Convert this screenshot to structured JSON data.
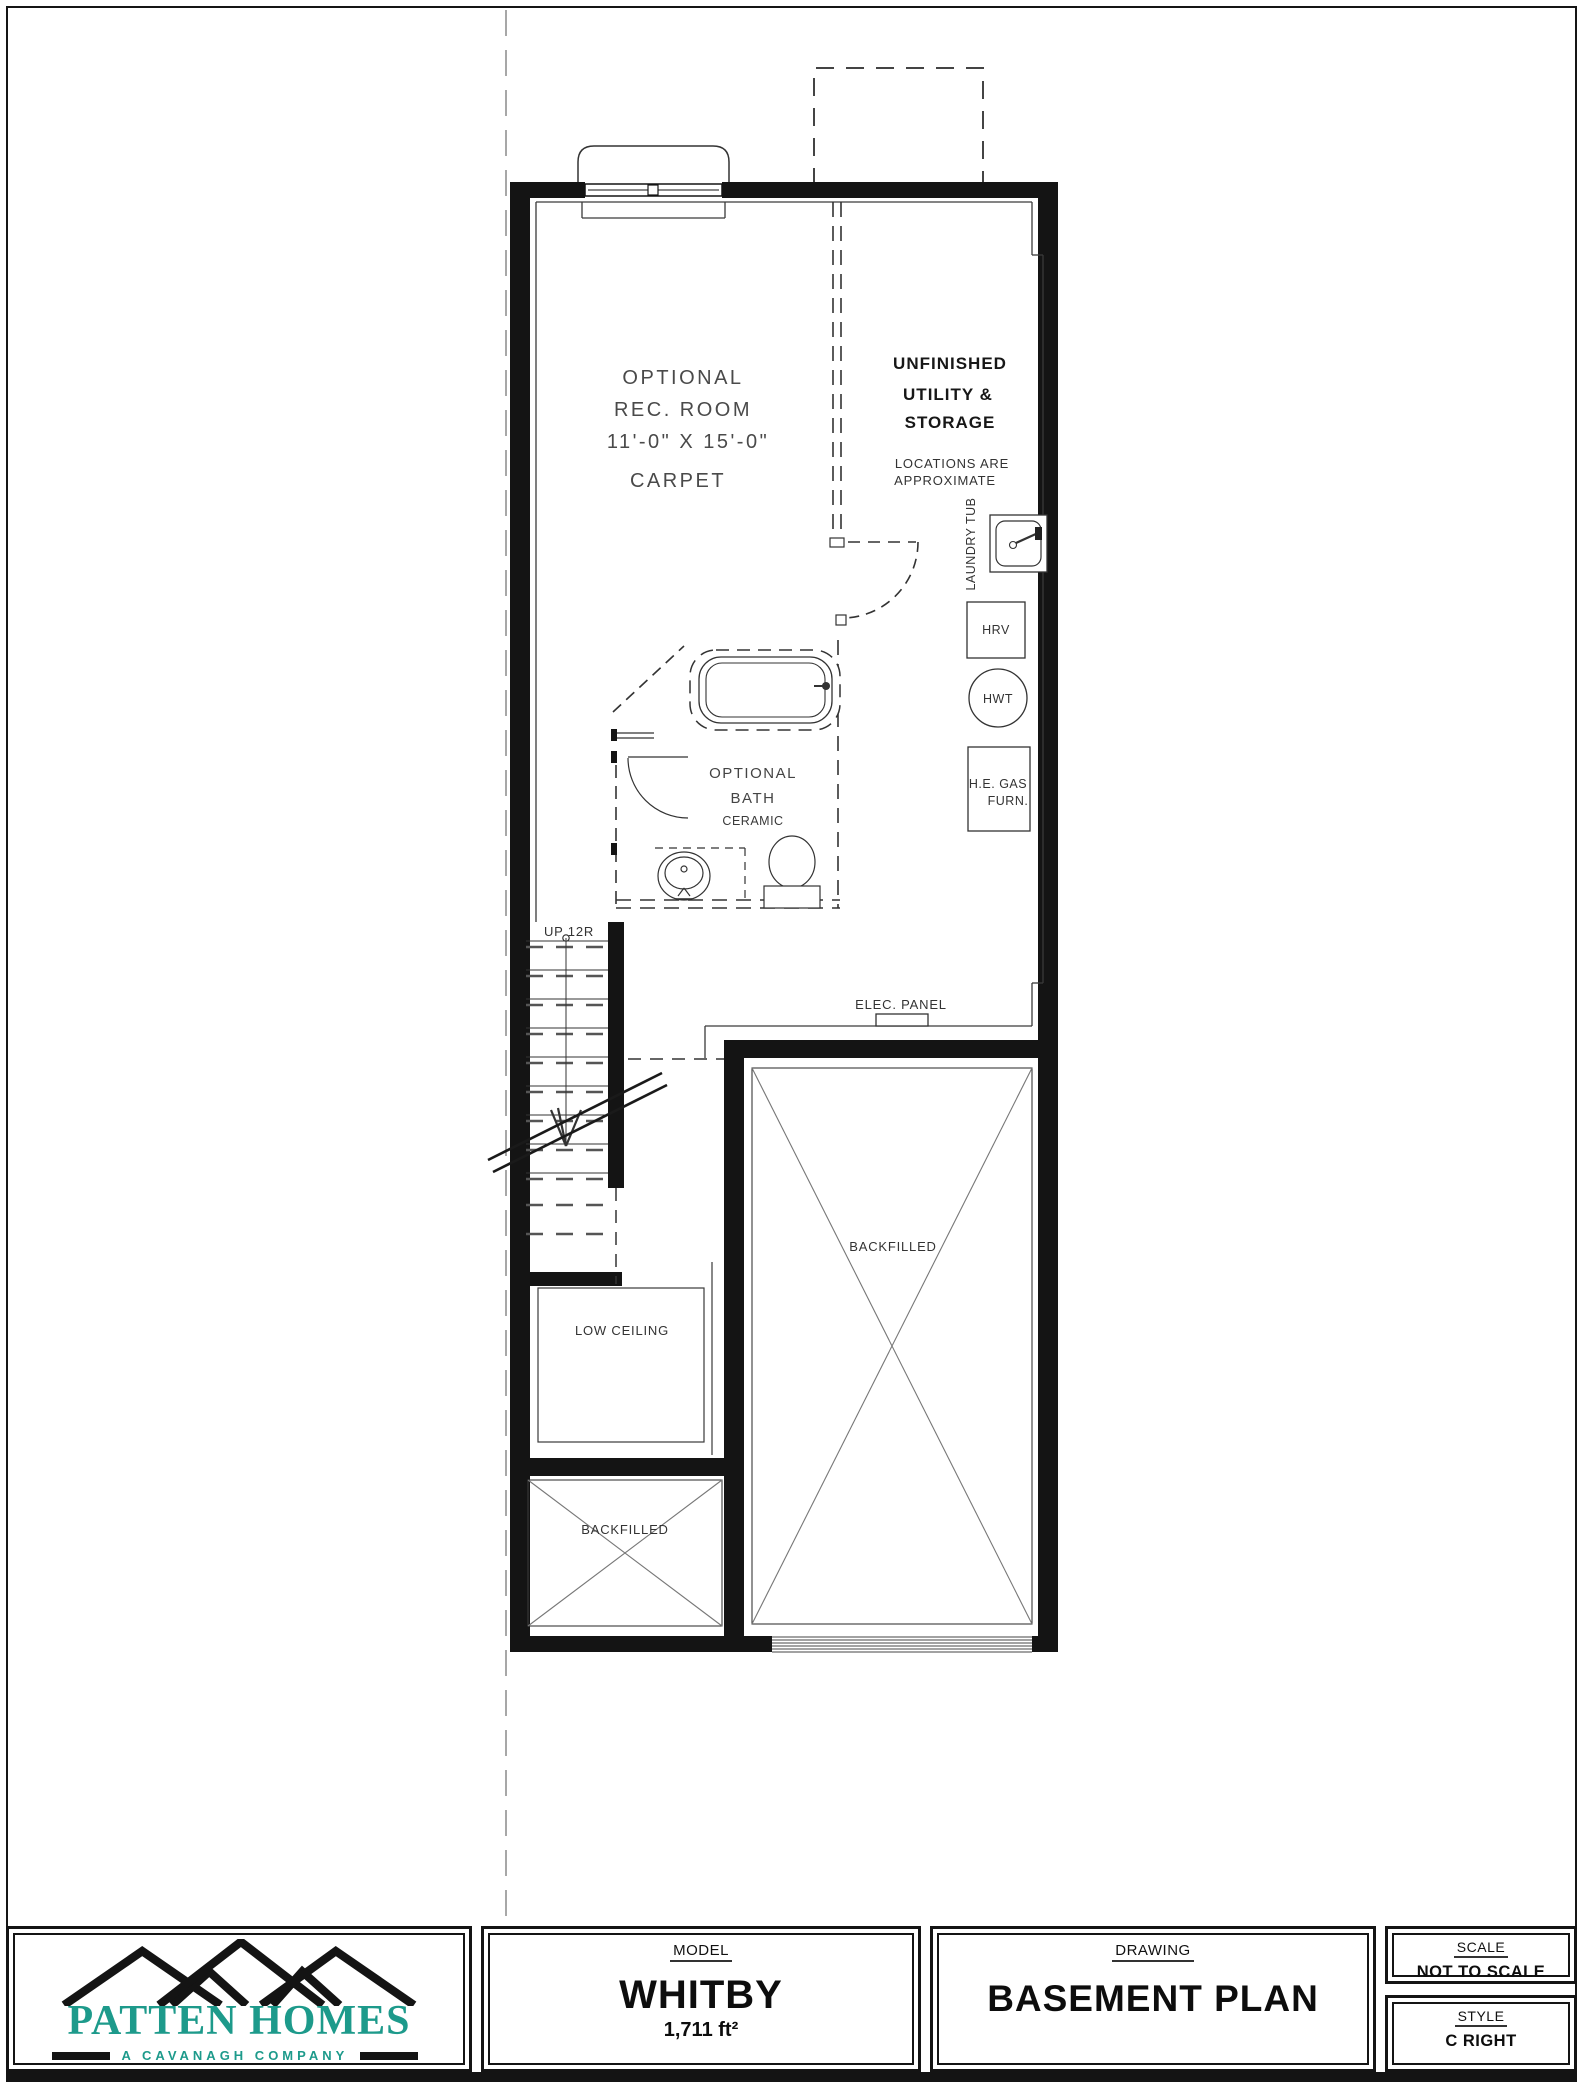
{
  "plan": {
    "rec_room": {
      "l1": "OPTIONAL",
      "l2": "REC. ROOM",
      "l3": "11'-0\" X 15'-0\"",
      "l4": "CARPET"
    },
    "utility": {
      "l1": "UNFINISHED",
      "l2": "UTILITY &",
      "l3": "STORAGE"
    },
    "locations": {
      "l1": "LOCATIONS ARE",
      "l2": "APPROXIMATE"
    },
    "fixtures": {
      "laundry_tub": "LAUNDRY TUB",
      "hrv": "HRV",
      "hwt": "HWT",
      "furnace_l1": "H.E. GAS",
      "furnace_l2": "FURN."
    },
    "bath": {
      "l1": "OPTIONAL",
      "l2": "BATH",
      "l3": "CERAMIC"
    },
    "stairs_label": "UP 12R",
    "elec_panel": "ELEC. PANEL",
    "garage_backfilled": "BACKFILLED",
    "small_backfilled": "BACKFILLED",
    "low_ceiling": "LOW CEILING"
  },
  "title_block": {
    "logo": {
      "name": "PATTEN HOMES",
      "tagline": "A CAVANAGH COMPANY"
    },
    "model": {
      "heading": "MODEL",
      "value": "WHITBY",
      "area": "1,711 ft²"
    },
    "drawing": {
      "heading": "DRAWING",
      "value": "BASEMENT PLAN"
    },
    "scale": {
      "heading": "SCALE",
      "value": "NOT TO SCALE"
    },
    "style": {
      "heading": "STYLE",
      "value": "C RIGHT"
    }
  },
  "colors": {
    "brand_teal": "#1d9a8b",
    "line_black": "#141414"
  }
}
